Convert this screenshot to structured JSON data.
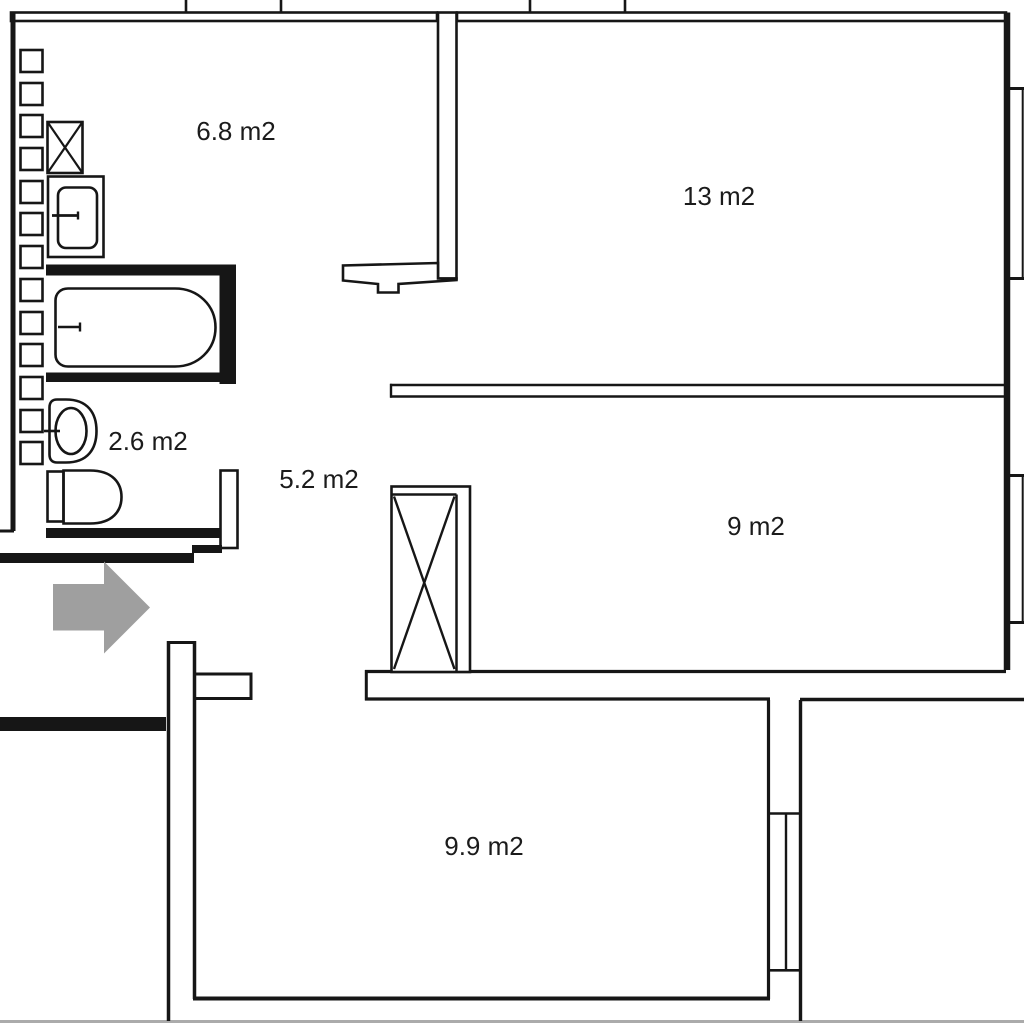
{
  "floorplan": {
    "type": "apartment-floor-plan",
    "area_unit": "m2",
    "rooms": [
      {
        "id": "bathroom",
        "area_label": "6.8 m2"
      },
      {
        "id": "living-room",
        "area_label": "13 m2"
      },
      {
        "id": "wc",
        "area_label": "2.6 m2"
      },
      {
        "id": "hallway",
        "area_label": "5.2 m2"
      },
      {
        "id": "bedroom",
        "area_label": "9 m2"
      },
      {
        "id": "kitchen",
        "area_label": "9.9 m2"
      }
    ],
    "fixtures": [
      "radiator-column",
      "washing-machine",
      "bathroom-sink",
      "bathtub",
      "washbasin",
      "toilet",
      "ventilation-shaft",
      "door-sill",
      "balcony-window",
      "entrance-arrow"
    ],
    "colors": {
      "wall": "#161616",
      "background": "#ffffff",
      "entrance_arrow": "#9f9f9f",
      "crop_edge": "#ababab"
    }
  }
}
